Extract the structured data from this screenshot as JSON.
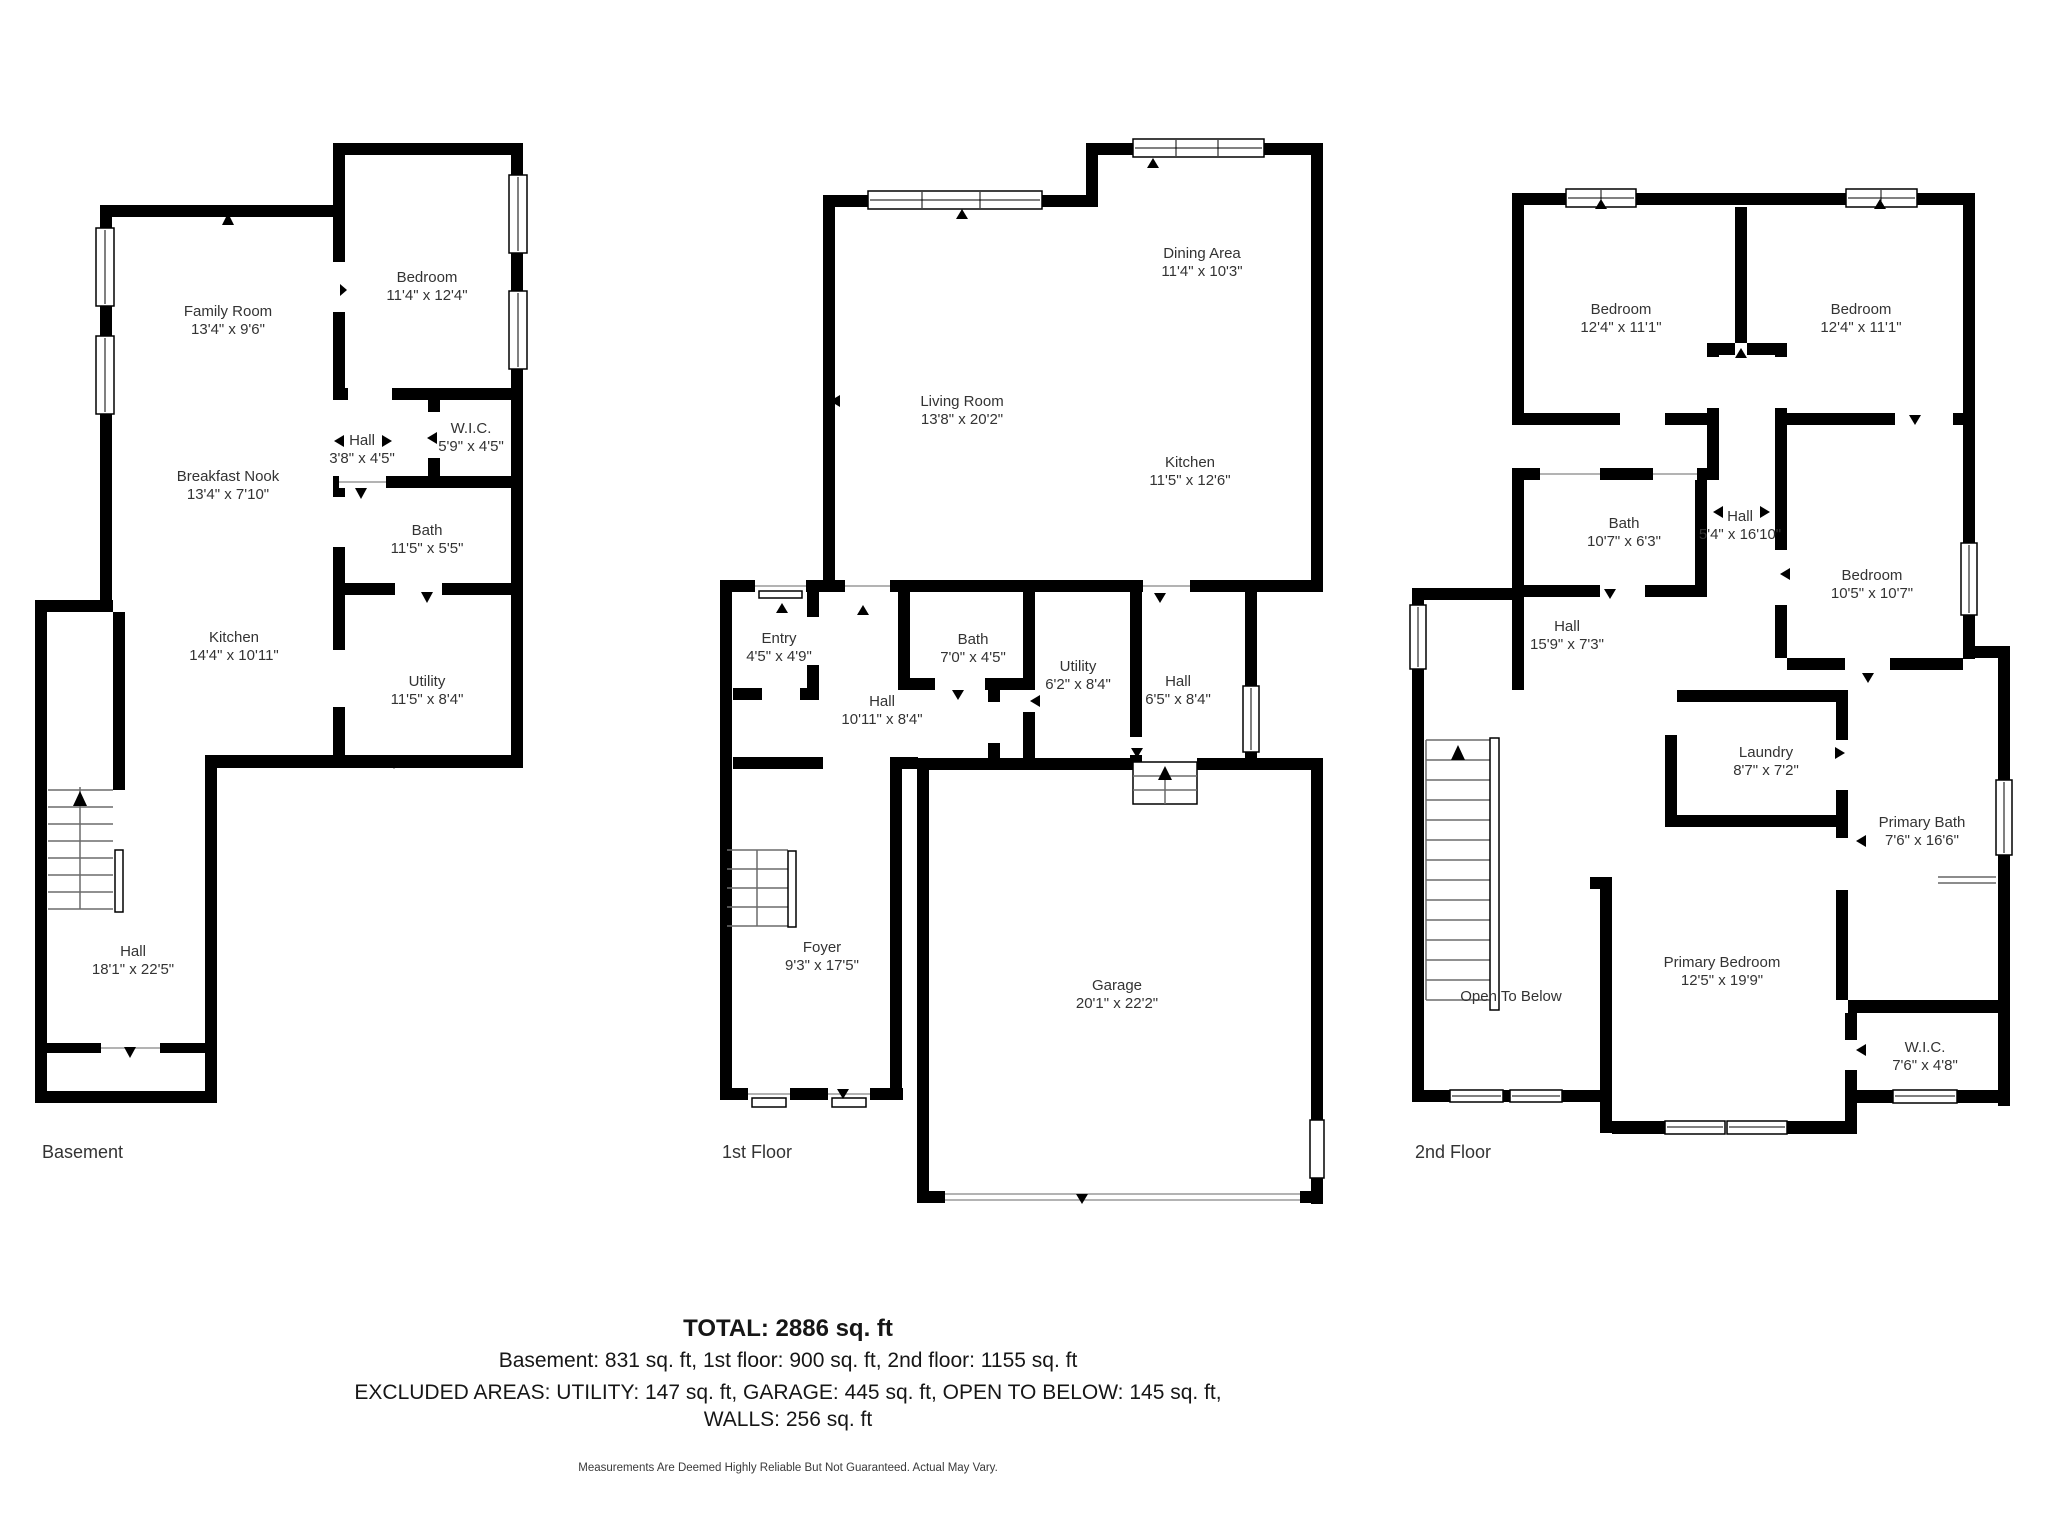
{
  "meta": {
    "background": "#ffffff",
    "wall_color": "#000000",
    "label_color": "#333333"
  },
  "floors": [
    {
      "label": "Basement",
      "rooms": [
        {
          "name": "Family Room",
          "dims": "13'4\" x 9'6\""
        },
        {
          "name": "Bedroom",
          "dims": "11'4\" x 12'4\""
        },
        {
          "name": "Hall",
          "dims": "3'8\" x 4'5\""
        },
        {
          "name": "W.I.C.",
          "dims": "5'9\" x 4'5\""
        },
        {
          "name": "Breakfast Nook",
          "dims": "13'4\" x 7'10\""
        },
        {
          "name": "Bath",
          "dims": "11'5\" x 5'5\""
        },
        {
          "name": "Kitchen",
          "dims": "14'4\" x 10'11\""
        },
        {
          "name": "Utility",
          "dims": "11'5\" x 8'4\""
        },
        {
          "name": "Hall",
          "dims": "18'1\" x 22'5\""
        }
      ]
    },
    {
      "label": "1st Floor",
      "rooms": [
        {
          "name": "Dining Area",
          "dims": "11'4\" x 10'3\""
        },
        {
          "name": "Living Room",
          "dims": "13'8\" x 20'2\""
        },
        {
          "name": "Kitchen",
          "dims": "11'5\" x 12'6\""
        },
        {
          "name": "Entry",
          "dims": "4'5\" x 4'9\""
        },
        {
          "name": "Bath",
          "dims": "7'0\" x 4'5\""
        },
        {
          "name": "Hall",
          "dims": "10'11\" x 8'4\""
        },
        {
          "name": "Utility",
          "dims": "6'2\" x 8'4\""
        },
        {
          "name": "Hall",
          "dims": "6'5\" x 8'4\""
        },
        {
          "name": "Foyer",
          "dims": "9'3\" x 17'5\""
        },
        {
          "name": "Garage",
          "dims": "20'1\" x 22'2\""
        }
      ]
    },
    {
      "label": "2nd Floor",
      "rooms": [
        {
          "name": "Bedroom",
          "dims": "12'4\" x 11'1\""
        },
        {
          "name": "Bedroom",
          "dims": "12'4\" x 11'1\""
        },
        {
          "name": "Bath",
          "dims": "10'7\" x 6'3\""
        },
        {
          "name": "Hall",
          "dims": "5'4\" x 16'10\""
        },
        {
          "name": "Bedroom",
          "dims": "10'5\" x 10'7\""
        },
        {
          "name": "Hall",
          "dims": "15'9\" x 7'3\""
        },
        {
          "name": "Laundry",
          "dims": "8'7\" x 7'2\""
        },
        {
          "name": "Primary Bath",
          "dims": "7'6\" x 16'6\""
        },
        {
          "name": "Open To Below",
          "dims": ""
        },
        {
          "name": "Primary Bedroom",
          "dims": "12'5\" x 19'9\""
        },
        {
          "name": "W.I.C.",
          "dims": "7'6\" x 4'8\""
        }
      ]
    }
  ],
  "summary": {
    "total": "TOTAL: 2886 sq. ft",
    "floors_line": "Basement: 831 sq. ft, 1st floor: 900 sq. ft, 2nd floor: 1155 sq. ft",
    "excluded_line": "EXCLUDED AREAS: UTILITY: 147 sq. ft, GARAGE: 445 sq. ft, OPEN TO BELOW: 145 sq. ft,",
    "walls_line": "WALLS: 256 sq. ft",
    "disclaimer": "Measurements Are Deemed Highly Reliable But Not Guaranteed. Actual May Vary."
  }
}
